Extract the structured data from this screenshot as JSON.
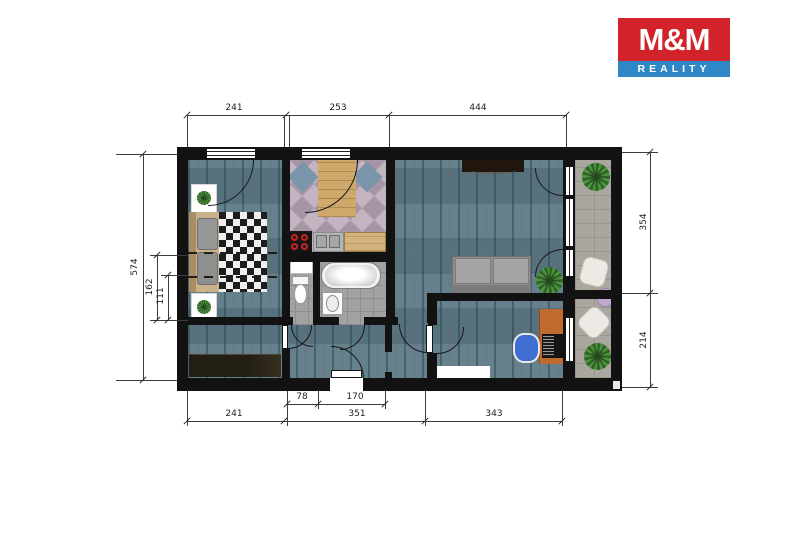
{
  "logo": {
    "title": "M&M",
    "subtitle": "REALITY",
    "red": "#d2232a",
    "blue": "#2f87c8"
  },
  "dims": {
    "top": [
      "241",
      "253",
      "444"
    ],
    "bottom_inner": [
      "78",
      "170"
    ],
    "bottom_outer": [
      "241",
      "351",
      "343"
    ],
    "left": [
      "574",
      "162",
      "111"
    ],
    "right": [
      "354",
      "214"
    ]
  },
  "colors": {
    "wall": "#121212",
    "wood_floor": "#5d7a87",
    "kitchen_tile": "#b3a2b0",
    "kitchen_tile_accent": "#7b95aa",
    "bath_tile": "#a2a2a2",
    "balcony_tile": "#aaa79e",
    "desk": "#c06a30",
    "office_chair": "#3e6fd0",
    "balcony_table": "#c0a8cf",
    "dimension_text": "#1e1e1e"
  }
}
